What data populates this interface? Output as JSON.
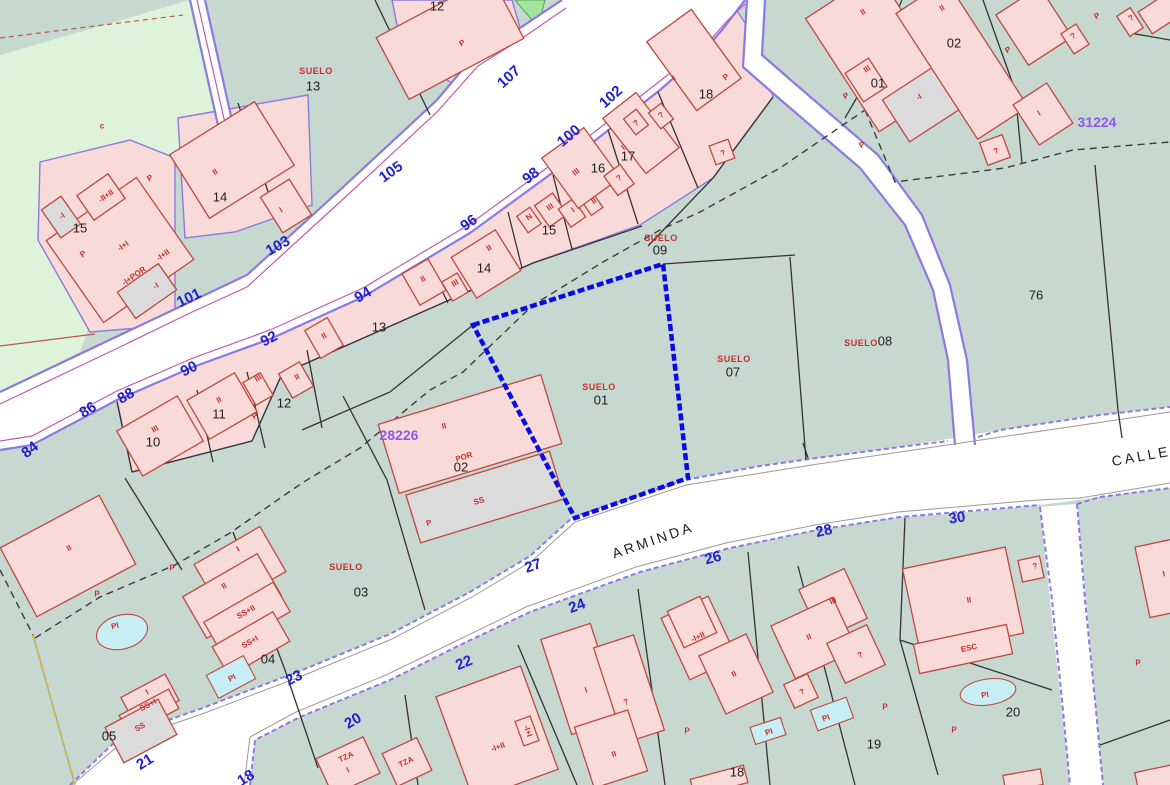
{
  "map": {
    "selected_parcel": "01",
    "colors": {
      "background": "#cfe0d6",
      "parcel_teal": "#c7d8d0",
      "parcel_light_green": "#def3da",
      "parcel_bright_green": "#a2e69c",
      "building_pink": "#f8dbd8",
      "building_gray": "#dbdbdb",
      "building_stroke": "#bf4840",
      "road_white": "#ffffff",
      "road_border_purple": "#8b7ae0",
      "road_line_magenta": "#c55aaa",
      "boundary_black": "#333333",
      "dashed_boundary": "#3c3c3c",
      "dashed_yellow": "#d8b93c",
      "highlight_blue": "#0a0ae6",
      "pool_cyan": "#c6eef4",
      "label_red": "#c6302c",
      "label_blue": "#2222cc",
      "label_purple": "#8a5ae8",
      "label_black": "#1f1f1f"
    },
    "street_names": [
      {
        "text": "ARMINDA",
        "x": 653,
        "y": 540,
        "rot": -19
      },
      {
        "text": "CALLE",
        "x": 1141,
        "y": 456,
        "rot": -10
      }
    ],
    "codes": [
      {
        "text": "28226",
        "x": 399,
        "y": 435
      },
      {
        "text": "31224",
        "x": 1097,
        "y": 122
      }
    ],
    "street_numbers": [
      {
        "text": "84",
        "x": 30,
        "y": 450,
        "rot": -38
      },
      {
        "text": "86",
        "x": 88,
        "y": 410,
        "rot": -32
      },
      {
        "text": "88",
        "x": 126,
        "y": 396,
        "rot": -30
      },
      {
        "text": "90",
        "x": 189,
        "y": 369,
        "rot": -26
      },
      {
        "text": "92",
        "x": 269,
        "y": 339,
        "rot": -28
      },
      {
        "text": "94",
        "x": 363,
        "y": 295,
        "rot": -30
      },
      {
        "text": "96",
        "x": 469,
        "y": 223,
        "rot": -36
      },
      {
        "text": "98",
        "x": 531,
        "y": 176,
        "rot": -38
      },
      {
        "text": "100",
        "x": 569,
        "y": 136,
        "rot": -40
      },
      {
        "text": "102",
        "x": 611,
        "y": 97,
        "rot": -42
      },
      {
        "text": "101",
        "x": 189,
        "y": 298,
        "rot": -26
      },
      {
        "text": "103",
        "x": 278,
        "y": 246,
        "rot": -30
      },
      {
        "text": "105",
        "x": 391,
        "y": 172,
        "rot": -35
      },
      {
        "text": "107",
        "x": 509,
        "y": 77,
        "rot": -42
      },
      {
        "text": "27",
        "x": 533,
        "y": 566,
        "rot": -18
      },
      {
        "text": "26",
        "x": 713,
        "y": 558,
        "rot": -15
      },
      {
        "text": "24",
        "x": 577,
        "y": 606,
        "rot": -20
      },
      {
        "text": "23",
        "x": 294,
        "y": 678,
        "rot": -26
      },
      {
        "text": "22",
        "x": 464,
        "y": 663,
        "rot": -22
      },
      {
        "text": "21",
        "x": 145,
        "y": 762,
        "rot": -32
      },
      {
        "text": "20",
        "x": 353,
        "y": 721,
        "rot": -30
      },
      {
        "text": "18",
        "x": 246,
        "y": 778,
        "rot": -32
      },
      {
        "text": "28",
        "x": 824,
        "y": 531,
        "rot": -12
      },
      {
        "text": "30",
        "x": 957,
        "y": 518,
        "rot": -8
      }
    ],
    "parcel_numbers": [
      {
        "text": "13",
        "x": 313,
        "y": 86
      },
      {
        "text": "14",
        "x": 220,
        "y": 197
      },
      {
        "text": "15",
        "x": 80,
        "y": 228
      },
      {
        "text": "12",
        "x": 437,
        "y": 6
      },
      {
        "text": "10",
        "x": 153,
        "y": 442
      },
      {
        "text": "11",
        "x": 219,
        "y": 414
      },
      {
        "text": "12",
        "x": 284,
        "y": 403
      },
      {
        "text": "13",
        "x": 379,
        "y": 327
      },
      {
        "text": "14",
        "x": 484,
        "y": 268
      },
      {
        "text": "15",
        "x": 549,
        "y": 230
      },
      {
        "text": "16",
        "x": 598,
        "y": 168
      },
      {
        "text": "17",
        "x": 628,
        "y": 156
      },
      {
        "text": "18",
        "x": 706,
        "y": 94
      },
      {
        "text": "09",
        "x": 660,
        "y": 250
      },
      {
        "text": "07",
        "x": 733,
        "y": 372
      },
      {
        "text": "08",
        "x": 885,
        "y": 341
      },
      {
        "text": "76",
        "x": 1036,
        "y": 295
      },
      {
        "text": "01",
        "x": 601,
        "y": 400
      },
      {
        "text": "02",
        "x": 461,
        "y": 467
      },
      {
        "text": "01",
        "x": 878,
        "y": 83
      },
      {
        "text": "02",
        "x": 954,
        "y": 43
      },
      {
        "text": "03",
        "x": 361,
        "y": 592
      },
      {
        "text": "04",
        "x": 268,
        "y": 659
      },
      {
        "text": "05",
        "x": 109,
        "y": 736
      },
      {
        "text": "19",
        "x": 874,
        "y": 744
      },
      {
        "text": "20",
        "x": 1013,
        "y": 712
      },
      {
        "text": "18",
        "x": 737,
        "y": 772
      }
    ],
    "suelo_labels": [
      {
        "text": "SUELO",
        "x": 316,
        "y": 71
      },
      {
        "text": "SUELO",
        "x": 661,
        "y": 238
      },
      {
        "text": "SUELO",
        "x": 734,
        "y": 359
      },
      {
        "text": "SUELO",
        "x": 599,
        "y": 387
      },
      {
        "text": "SUELO",
        "x": 861,
        "y": 343
      },
      {
        "text": "SUELO",
        "x": 346,
        "y": 567
      }
    ],
    "building_labels": [
      {
        "text": "c",
        "x": 102,
        "y": 126,
        "s": 9
      },
      {
        "text": "P",
        "x": 150,
        "y": 178,
        "rot": -35
      },
      {
        "text": "-II+II",
        "x": 106,
        "y": 196,
        "rot": -35
      },
      {
        "text": "-I",
        "x": 62,
        "y": 216,
        "rot": -35
      },
      {
        "text": "-I+I",
        "x": 123,
        "y": 246,
        "rot": -35
      },
      {
        "text": "-I+II",
        "x": 163,
        "y": 255,
        "rot": -35
      },
      {
        "text": "-I+POR",
        "x": 134,
        "y": 276,
        "rot": -35
      },
      {
        "text": "-I",
        "x": 156,
        "y": 286,
        "rot": -35
      },
      {
        "text": "P",
        "x": 83,
        "y": 254,
        "rot": -35
      },
      {
        "text": "II",
        "x": 215,
        "y": 172,
        "rot": -32
      },
      {
        "text": "I",
        "x": 281,
        "y": 210,
        "rot": -32
      },
      {
        "text": "P",
        "x": 462,
        "y": 43,
        "rot": -28
      },
      {
        "text": "III",
        "x": 155,
        "y": 429,
        "rot": -30
      },
      {
        "text": "II",
        "x": 219,
        "y": 400,
        "rot": -30
      },
      {
        "text": "P",
        "x": 255,
        "y": 416,
        "rot": -30
      },
      {
        "text": "III",
        "x": 258,
        "y": 378,
        "rot": -30
      },
      {
        "text": "II",
        "x": 297,
        "y": 377,
        "rot": -30
      },
      {
        "text": "II",
        "x": 324,
        "y": 336,
        "rot": -30
      },
      {
        "text": "II",
        "x": 423,
        "y": 279,
        "rot": -30
      },
      {
        "text": "III",
        "x": 455,
        "y": 283,
        "rot": -30
      },
      {
        "text": "II",
        "x": 489,
        "y": 248,
        "rot": -32
      },
      {
        "text": "N",
        "x": 529,
        "y": 217,
        "rot": -35
      },
      {
        "text": "III",
        "x": 550,
        "y": 207,
        "rot": -35
      },
      {
        "text": "I",
        "x": 573,
        "y": 210,
        "rot": -35
      },
      {
        "text": "II",
        "x": 594,
        "y": 201,
        "rot": -35
      },
      {
        "text": "III",
        "x": 576,
        "y": 172,
        "rot": -36
      },
      {
        "text": "?",
        "x": 619,
        "y": 178,
        "rot": -36
      },
      {
        "text": "II",
        "x": 624,
        "y": 147,
        "rot": -38
      },
      {
        "text": "?",
        "x": 636,
        "y": 123,
        "rot": -38
      },
      {
        "text": "?",
        "x": 661,
        "y": 115,
        "rot": -38
      },
      {
        "text": "I",
        "x": 674,
        "y": 78,
        "rot": -36
      },
      {
        "text": "P",
        "x": 726,
        "y": 77,
        "rot": -36
      },
      {
        "text": "?",
        "x": 723,
        "y": 153,
        "rot": -20
      },
      {
        "text": "P",
        "x": 846,
        "y": 96,
        "rot": -33
      },
      {
        "text": "II",
        "x": 863,
        "y": 12,
        "rot": -33
      },
      {
        "text": "III",
        "x": 867,
        "y": 69,
        "rot": -33
      },
      {
        "text": "-I",
        "x": 919,
        "y": 97,
        "rot": -33
      },
      {
        "text": "II",
        "x": 942,
        "y": 8,
        "rot": -33
      },
      {
        "text": "P",
        "x": 1008,
        "y": 50,
        "rot": -33
      },
      {
        "text": "?",
        "x": 1073,
        "y": 36,
        "rot": -33
      },
      {
        "text": "P",
        "x": 1097,
        "y": 16,
        "rot": -33
      },
      {
        "text": "?",
        "x": 1131,
        "y": 18,
        "rot": -33
      },
      {
        "text": "I",
        "x": 1039,
        "y": 113,
        "rot": -33
      },
      {
        "text": "P",
        "x": 862,
        "y": 145,
        "rot": -33
      },
      {
        "text": "?",
        "x": 996,
        "y": 151,
        "rot": -20
      },
      {
        "text": "II",
        "x": 444,
        "y": 426,
        "rot": -17
      },
      {
        "text": "POR",
        "x": 464,
        "y": 457,
        "rot": -17
      },
      {
        "text": "SS",
        "x": 479,
        "y": 501,
        "rot": -17
      },
      {
        "text": "P",
        "x": 429,
        "y": 523,
        "rot": -17
      },
      {
        "text": "II",
        "x": 69,
        "y": 548,
        "rot": -28
      },
      {
        "text": "P",
        "x": 97,
        "y": 594
      },
      {
        "text": "PI",
        "x": 115,
        "y": 626,
        "rot": -15
      },
      {
        "text": "P",
        "x": 172,
        "y": 568
      },
      {
        "text": "I",
        "x": 238,
        "y": 549,
        "rot": -30
      },
      {
        "text": "II",
        "x": 224,
        "y": 586,
        "rot": -30
      },
      {
        "text": "SS+II",
        "x": 246,
        "y": 612,
        "rot": -30
      },
      {
        "text": "SS+I",
        "x": 250,
        "y": 642,
        "rot": -30
      },
      {
        "text": "PI",
        "x": 232,
        "y": 678,
        "rot": -28
      },
      {
        "text": "I",
        "x": 147,
        "y": 692,
        "rot": -28
      },
      {
        "text": "SS+I",
        "x": 148,
        "y": 705,
        "rot": -28
      },
      {
        "text": "SS",
        "x": 140,
        "y": 727,
        "rot": -28
      },
      {
        "text": "TZA",
        "x": 346,
        "y": 757,
        "rot": -25
      },
      {
        "text": "I",
        "x": 348,
        "y": 770,
        "rot": -25
      },
      {
        "text": "TZA",
        "x": 406,
        "y": 762,
        "rot": -25
      },
      {
        "text": "-I+II",
        "x": 498,
        "y": 747,
        "rot": -20
      },
      {
        "text": "-I+I",
        "x": 528,
        "y": 731,
        "rot": 72
      },
      {
        "text": "I",
        "x": 586,
        "y": 690,
        "rot": -18
      },
      {
        "text": "?",
        "x": 626,
        "y": 702,
        "rot": -18
      },
      {
        "text": "II",
        "x": 614,
        "y": 754,
        "rot": -18
      },
      {
        "text": "-I+II",
        "x": 698,
        "y": 637,
        "rot": -25
      },
      {
        "text": "II",
        "x": 734,
        "y": 674,
        "rot": -25
      },
      {
        "text": "P",
        "x": 687,
        "y": 731
      },
      {
        "text": "PI",
        "x": 769,
        "y": 732,
        "rot": -18
      },
      {
        "text": "III",
        "x": 833,
        "y": 601,
        "rot": -25
      },
      {
        "text": "II",
        "x": 809,
        "y": 637,
        "rot": -25
      },
      {
        "text": "?",
        "x": 860,
        "y": 655,
        "rot": -25
      },
      {
        "text": "?",
        "x": 802,
        "y": 692,
        "rot": -25
      },
      {
        "text": "PI",
        "x": 826,
        "y": 718,
        "rot": -20
      },
      {
        "text": "P",
        "x": 885,
        "y": 707
      },
      {
        "text": "II",
        "x": 969,
        "y": 600,
        "rot": -12
      },
      {
        "text": "ESC",
        "x": 969,
        "y": 648,
        "rot": -12
      },
      {
        "text": "?",
        "x": 1035,
        "y": 566,
        "rot": -12
      },
      {
        "text": "PI",
        "x": 985,
        "y": 695,
        "rot": -8
      },
      {
        "text": "P",
        "x": 954,
        "y": 730
      },
      {
        "text": "P",
        "x": 1138,
        "y": 663
      },
      {
        "text": "I",
        "x": 1164,
        "y": 574,
        "rot": -12
      }
    ]
  }
}
